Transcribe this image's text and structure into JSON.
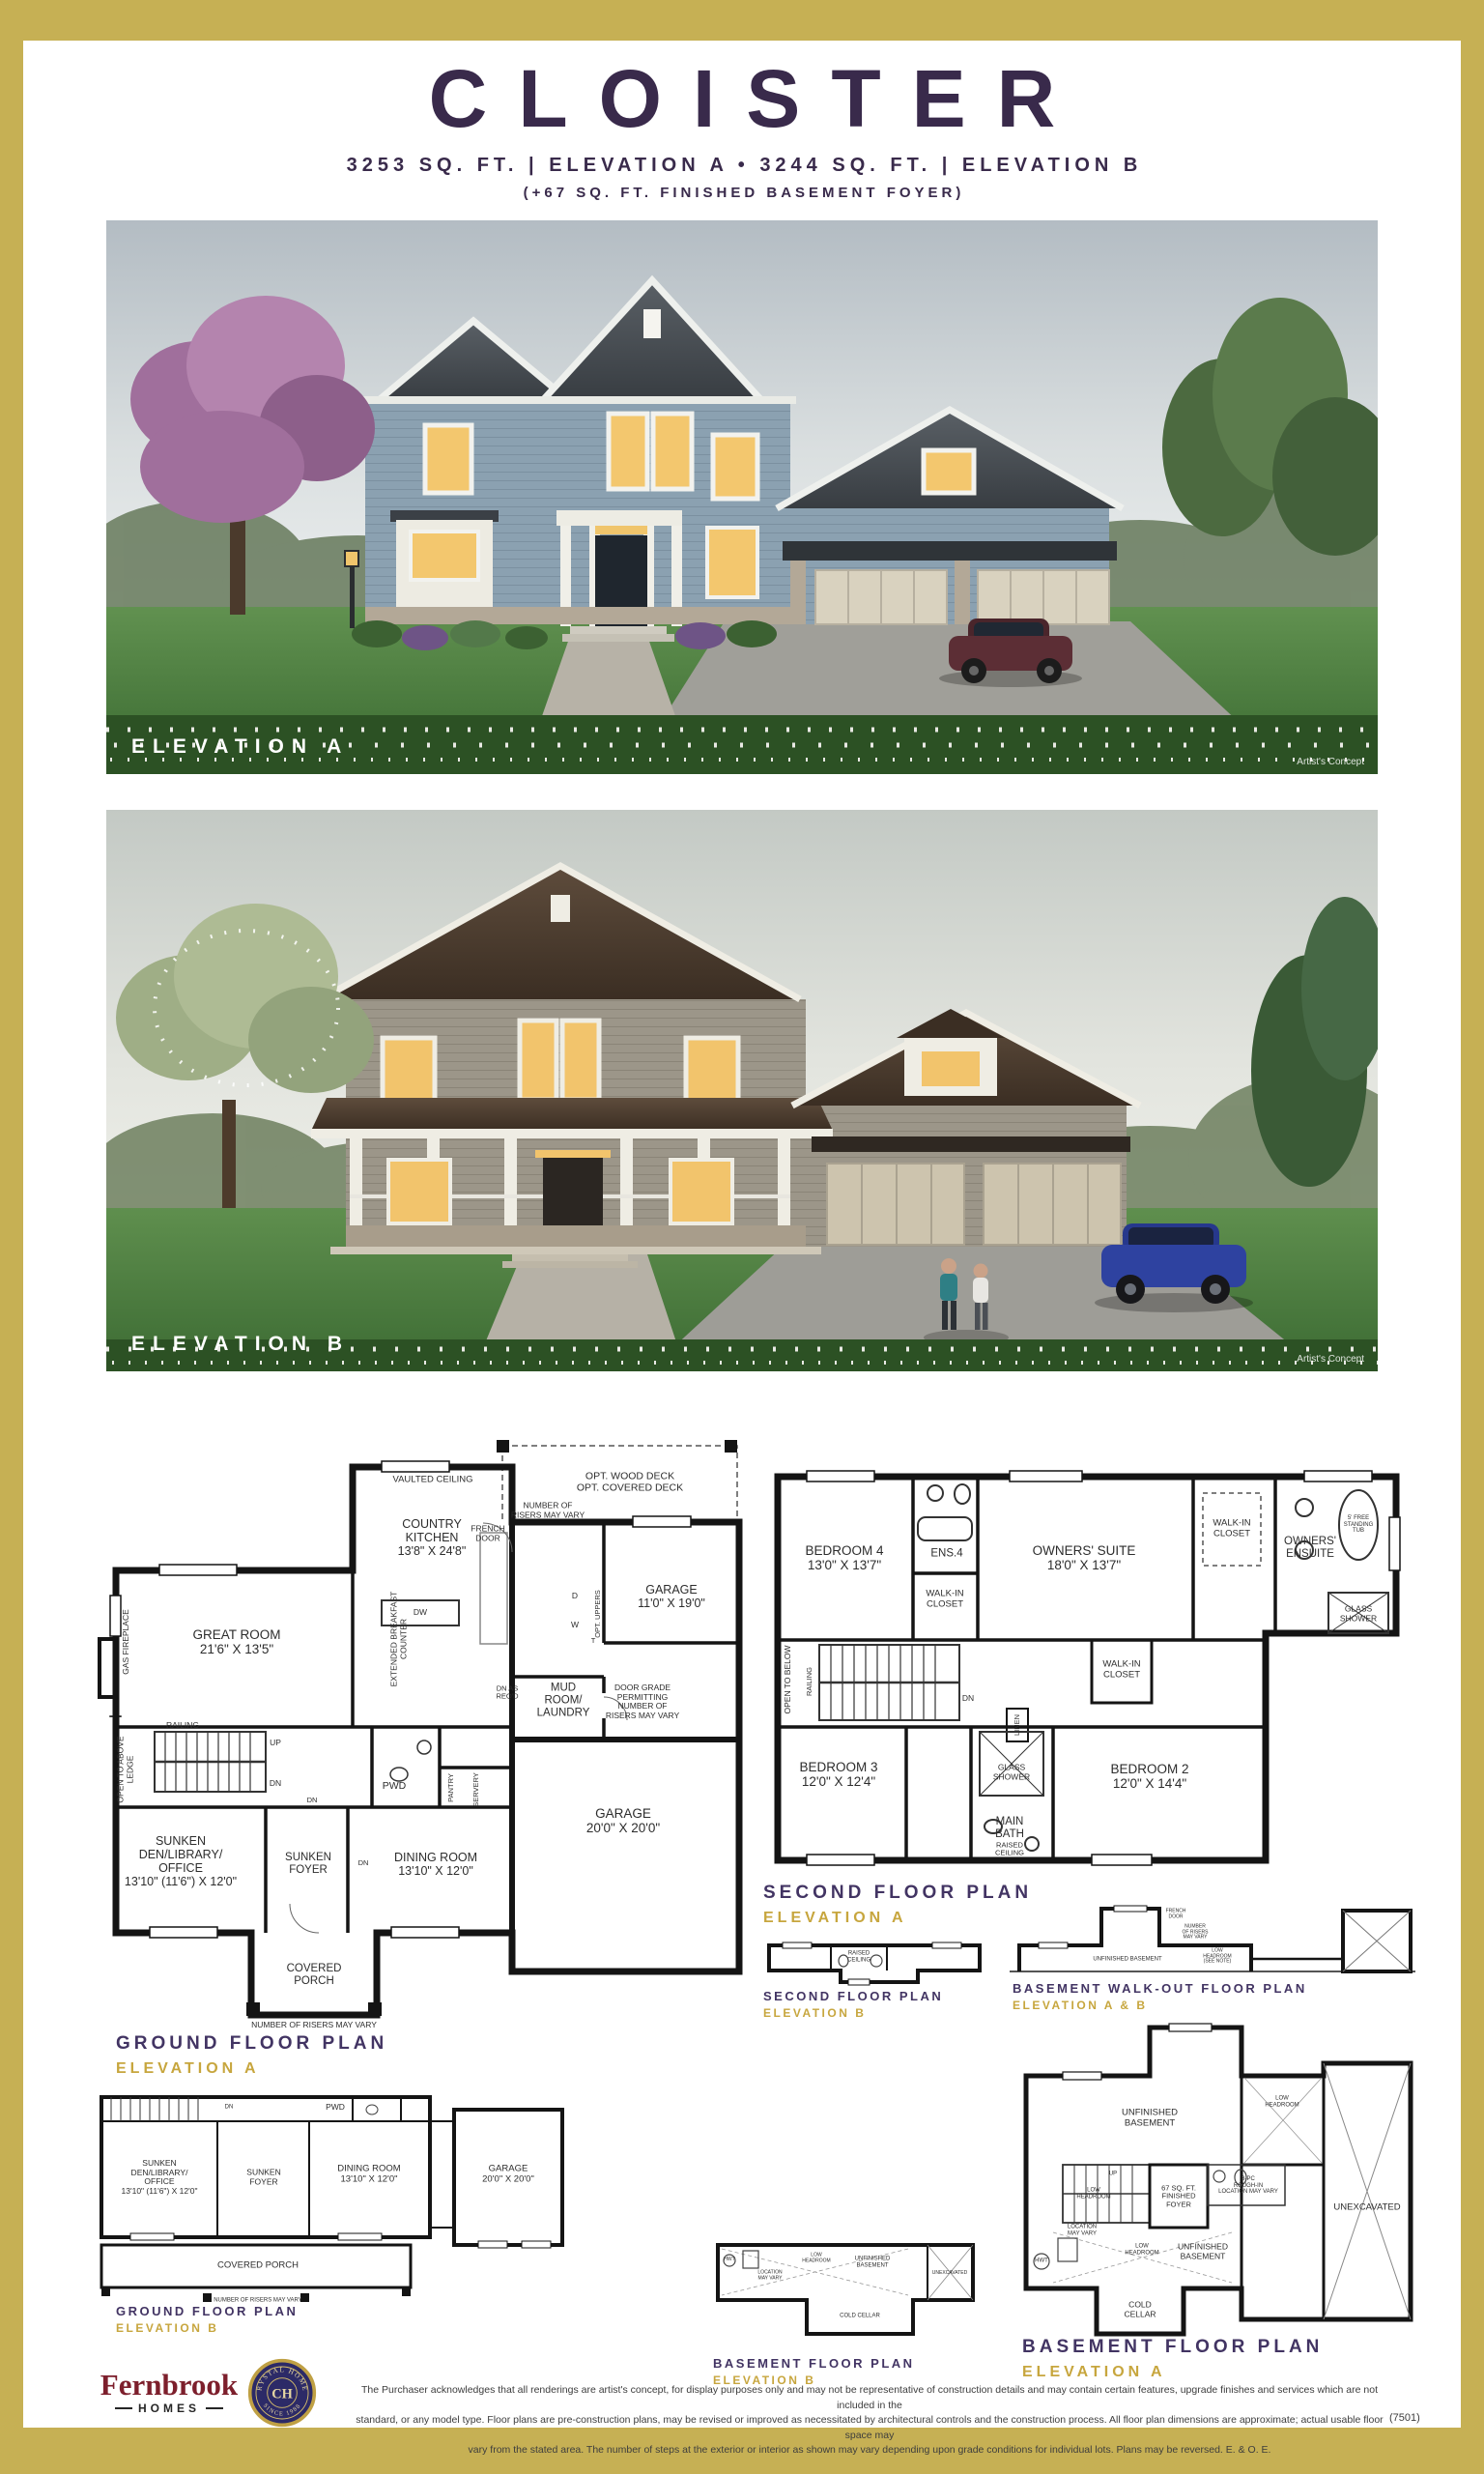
{
  "header": {
    "title": "CLOISTER",
    "subtitle": "3253 SQ. FT. | ELEVATION A • 3244 SQ. FT. | ELEVATION B",
    "subtitle2": "(+67 SQ. FT. FINISHED BASEMENT FOYER)"
  },
  "renderings": {
    "a": {
      "label": "ELEVATION A",
      "credit": "Artist's Concept"
    },
    "b": {
      "label": "ELEVATION B",
      "credit": "Artist's Concept"
    }
  },
  "plans": {
    "ground_a": {
      "title": "GROUND FLOOR PLAN",
      "elevation": "ELEVATION A",
      "labels": {
        "deck": "OPT. WOOD DECK\nOPT. COVERED DECK",
        "vaulted": "VAULTED CEILING",
        "kitchen": "COUNTRY\nKITCHEN\n13'8\" X 24'8\"",
        "french_door": "FRENCH\nDOOR",
        "risers_top": "NUMBER OF\nRISERS MAY VARY",
        "garage_small": "GARAGE\n11'0\" X 19'0\"",
        "great_room": "GREAT ROOM\n21'6\" X 13'5\"",
        "gas_fireplace": "GAS FIREPLACE",
        "breakfast_counter": "EXTENDED BREAKFAST\nCOUNTER",
        "dw": "DW",
        "opt_uppers": "OPT. UPPERS",
        "d": "D",
        "w": "W",
        "t": "T",
        "mud_room": "MUD\nROOM/\nLAUNDRY",
        "door_grade": "DOOR GRADE\nPERMITTING\nNUMBER OF\nRISERS MAY VARY",
        "dn_as_reqd": "DN AS\nREQ'D",
        "garage_main": "GARAGE\n20'0\" X 20'0\"",
        "railing": "RAILING",
        "up": "UP",
        "dn": "DN",
        "open_above": "OPEN TO ABOVE\nLEDGE",
        "pwd": "PWD",
        "pantry": "PANTRY",
        "servery": "SERVERY",
        "den": "SUNKEN\nDEN/LIBRARY/\nOFFICE\n13'10\" (11'6\") X 12'0\"",
        "foyer": "SUNKEN\nFOYER",
        "dining": "DINING ROOM\n13'10\" X 12'0\"",
        "porch": "COVERED\nPORCH",
        "risers_bottom": "NUMBER OF RISERS MAY VARY"
      }
    },
    "second_a": {
      "title": "SECOND FLOOR PLAN",
      "elevation": "ELEVATION A",
      "labels": {
        "bedroom4": "BEDROOM 4\n13'0\" X 13'7\"",
        "ens4": "ENS.4",
        "wic_bed4": "WALK-IN\nCLOSET",
        "owners_suite": "OWNERS' SUITE\n18'0\" X 13'7\"",
        "wic_owners": "WALK-IN\nCLOSET",
        "owners_ensuite": "OWNERS'\nENSUITE",
        "tub": "5' FREE\nSTANDING\nTUB",
        "glass_shower_ens": "GLASS\nSHOWER",
        "open_below": "OPEN TO BELOW",
        "railing": "RAILING",
        "dn": "DN",
        "wic_bed2": "WALK-IN\nCLOSET",
        "linen": "LINEN",
        "bedroom3": "BEDROOM 3\n12'0\" X 12'4\"",
        "glass_shower_main": "GLASS\nSHOWER",
        "main_bath": "MAIN\nBATH",
        "raised_ceiling": "RAISED\nCEILING",
        "bedroom2": "BEDROOM 2\n12'0\" X 14'4\""
      }
    },
    "second_b": {
      "title": "SECOND FLOOR PLAN",
      "elevation": "ELEVATION B",
      "labels": {
        "raised_ceiling": "RAISED\nCEILING"
      }
    },
    "walkout": {
      "title": "BASEMENT WALK-OUT FLOOR PLAN",
      "elevation": "ELEVATION A & B",
      "labels": {
        "unfinished": "UNFINISHED BASEMENT",
        "french_door": "FRENCH\nDOOR",
        "risers": "NUMBER\nOF RISERS\nMAY VARY",
        "low_headroom": "LOW\nHEADROOM\n(SEE NOTE)"
      }
    },
    "ground_b": {
      "title": "GROUND FLOOR PLAN",
      "elevation": "ELEVATION B",
      "labels": {
        "pwd": "PWD",
        "dn": "DN",
        "den": "SUNKEN\nDEN/LIBRARY/\nOFFICE\n13'10\" (11'6\") X 12'0\"",
        "foyer": "SUNKEN\nFOYER",
        "dining": "DINING ROOM\n13'10\" X 12'0\"",
        "garage": "GARAGE\n20'0\" X 20'0\"",
        "porch": "COVERED PORCH",
        "risers": "NUMBER OF RISERS MAY VARY"
      }
    },
    "basement_b": {
      "title": "BASEMENT FLOOR PLAN",
      "elevation": "ELEVATION B",
      "labels": {
        "hwt": "HWT",
        "location": "LOCATION\nMAY VARY",
        "low_headroom": "LOW\nHEADROOM",
        "unfinished": "UNFINISHED\nBASEMENT",
        "cold_cellar": "COLD CELLAR",
        "unexcavated": "UNEXCAVATED"
      }
    },
    "basement_a": {
      "title": "BASEMENT FLOOR PLAN",
      "elevation": "ELEVATION A",
      "labels": {
        "unfinished_top": "UNFINISHED\nBASEMENT",
        "low_headroom_tr": "LOW\nHEADROOM",
        "unexcavated": "UNEXCAVATED",
        "low_headroom_stairs": "LOW\nHEADROOM",
        "up": "UP",
        "foyer": "67 SQ. FT.\nFINISHED\nFOYER",
        "rough_in": "3-PC\nROUGH-IN\nLOCATION MAY VARY",
        "location": "LOCATION\nMAY VARY",
        "hwt": "HWT",
        "low_headroom_c": "LOW\nHEADROOM",
        "unfinished_right": "UNFINISHED\nBASEMENT",
        "cold_cellar": "COLD\nCELLAR"
      }
    }
  },
  "footer": {
    "fernbrook": "Fernbrook",
    "fernbrook_sub": "HOMES",
    "seal_top": "CRYSTAL HOMES",
    "seal_bottom": "SINCE 1988",
    "seal_mono": "CH",
    "disclaimer_1": "The Purchaser acknowledges that all renderings are artist's concept, for display purposes only and may not be representative of construction details and may contain certain features, upgrade finishes and services which are not included in the",
    "disclaimer_2": "standard, or any model type. Floor plans are pre-construction plans, may be revised or improved as necessitated by architectural controls and the construction process. All floor plan dimensions are approximate; actual usable floor space may",
    "disclaimer_3": "vary from the stated area. The number of steps at the exterior or interior as shown may vary depending upon grade conditions for individual lots. Plans may be reversed. E. & O. E.",
    "code": "(7501)"
  }
}
